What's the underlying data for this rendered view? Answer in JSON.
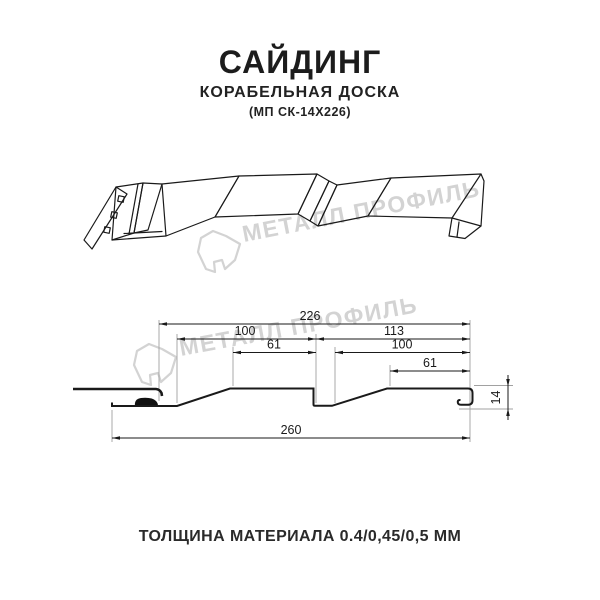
{
  "header": {
    "title": "САЙДИНГ",
    "subtitle": "КОРАБЕЛЬНАЯ ДОСКА",
    "product_code": "(МП СК-14Х226)"
  },
  "watermark": {
    "brand": "МЕТАЛЛ ПРОФИЛЬ"
  },
  "cross_section": {
    "dim_top_width": "226",
    "dim_left_pitch": "100",
    "dim_right_pitch": "113",
    "dim_left_flat": "61",
    "dim_right_inner": "100",
    "dim_right_flat": "61",
    "dim_overall_width": "260",
    "dim_height": "14"
  },
  "footer": {
    "thickness_label": "ТОЛЩИНА МАТЕРИАЛА 0.4/0,45/0,5 ММ"
  },
  "colors": {
    "ink": "#1a1a1a",
    "extension_line": "#a1a1a1",
    "watermark": "#d3d3d3"
  }
}
